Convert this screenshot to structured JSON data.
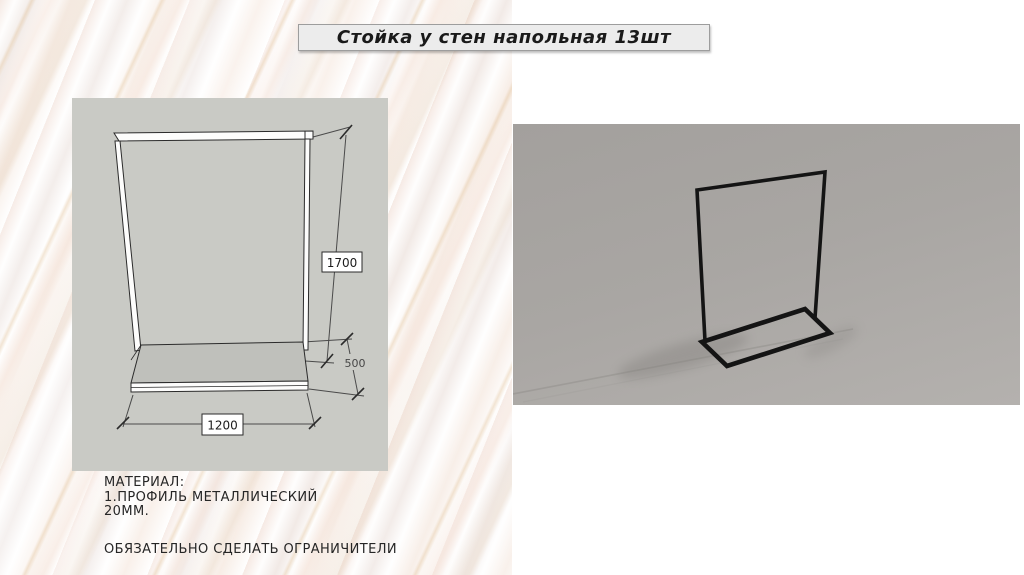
{
  "title": {
    "label": "Стойка у стен напольная 13шт"
  },
  "drawing": {
    "dim_height": "1700",
    "dim_depth": "500",
    "dim_width": "1200"
  },
  "notes": {
    "material_heading": "МАТЕРИАЛ:",
    "material_item": "1.ПРОФИЛЬ МЕТАЛЛИЧЕСКИЙ",
    "material_size": "20ММ.",
    "requirement": "ОБЯЗАТЕЛЬНО СДЕЛАТЬ ОГРАНИЧИТЕЛИ"
  },
  "colors": {
    "sketch_background": "#c9cac5",
    "render_background": "#a9a6a3",
    "frame_stroke": "#141414",
    "platform_fill": "#bfc0bb",
    "title_box_background": "#ececec"
  }
}
